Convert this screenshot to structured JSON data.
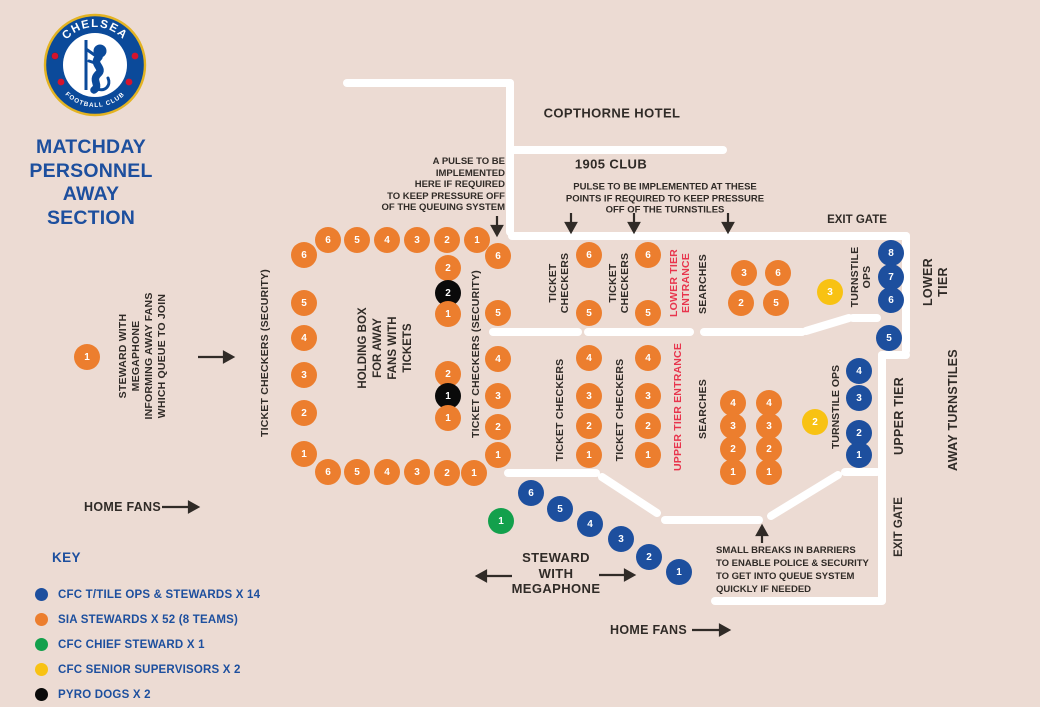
{
  "colors": {
    "blue": "#1d4f9e",
    "orange": "#ec7e2e",
    "green": "#13a04c",
    "yellow": "#f8c213",
    "black": "#0a0a0a",
    "wall": "#ffffff",
    "ink": "#302b27",
    "red": "#e8354d",
    "bg": "#ecdbd3"
  },
  "logo": {
    "top_text": "CHELSEA",
    "bottom_text": "FOOTBALL CLUB"
  },
  "title": {
    "lines": "MATCHDAY\nPERSONNEL\nAWAY\nSECTION"
  },
  "labels": {
    "copthorne_hotel": "COPTHORNE HOTEL",
    "club_1905": "1905 CLUB",
    "exit_gate_top": "EXIT GATE",
    "exit_gate_right": "EXIT GATE",
    "lower_tier": "LOWER\nTIER",
    "upper_tier": "UPPER TIER",
    "away_turnstiles": "AWAY TURNSTILES",
    "home_fans_left": "HOME FANS",
    "home_fans_bottom": "HOME FANS",
    "steward_megaphone_left": "STEWARD WITH\nMEGAPHONE\nINFORMING AWAY FANS\nWHICH QUEUE TO JOIN",
    "steward_megaphone_bottom": "STEWARD\nWITH\nMEGAPHONE",
    "ticket_checkers_security": "TICKET CHECKERS (SECURITY)",
    "holding_box": "HOLDING BOX\nFOR AWAY\nFANS WITH\nTICKETS",
    "ticket_checkers_2line": "TICKET\nCHECKERS",
    "ticket_checkers_1line": "TICKET CHECKERS",
    "lower_tier_entrance": "LOWER TIER\nENTRANCE",
    "upper_tier_entrance": "UPPER TIER ENTRANCE",
    "searches": "SEARCHES",
    "turnstile_ops_2line": "TURNSTILE\nOPS",
    "turnstile_ops_1line": "TURNSTILE OPS"
  },
  "annotations": {
    "pulse_left": "A PULSE TO BE\nIMPLEMENTED\nHERE IF REQUIRED\nTO KEEP PRESSURE OFF\nOF THE QUEUING SYSTEM",
    "pulse_right": "PULSE TO BE IMPLEMENTED AT THESE\nPOINTS IF REQUIRED TO KEEP PRESSURE\nOFF OF THE TURNSTILES",
    "small_breaks": "SMALL BREAKS IN BARRIERS\nTO ENABLE POLICE & SECURITY\nTO GET INTO QUEUE SYSTEM\nQUICKLY IF NEEDED"
  },
  "key": {
    "heading": "KEY",
    "items": [
      {
        "color": "blue",
        "label": "CFC T/TILE OPS & STEWARDS X 14"
      },
      {
        "color": "orange",
        "label": "SIA STEWARDS X 52 (8 TEAMS)"
      },
      {
        "color": "green",
        "label": "CFC CHIEF STEWARD X 1"
      },
      {
        "color": "yellow",
        "label": "CFC SENIOR SUPERVISORS X 2"
      },
      {
        "color": "black",
        "label": "PYRO DOGS X 2"
      }
    ]
  },
  "markers": [
    {
      "c": "orange",
      "n": "6",
      "x": 328,
      "y": 240
    },
    {
      "c": "orange",
      "n": "5",
      "x": 357,
      "y": 240
    },
    {
      "c": "orange",
      "n": "4",
      "x": 387,
      "y": 240
    },
    {
      "c": "orange",
      "n": "3",
      "x": 417,
      "y": 240
    },
    {
      "c": "orange",
      "n": "2",
      "x": 447,
      "y": 240
    },
    {
      "c": "orange",
      "n": "1",
      "x": 477,
      "y": 240
    },
    {
      "c": "orange",
      "n": "6",
      "x": 304,
      "y": 255
    },
    {
      "c": "orange",
      "n": "5",
      "x": 304,
      "y": 303
    },
    {
      "c": "orange",
      "n": "4",
      "x": 304,
      "y": 338
    },
    {
      "c": "orange",
      "n": "3",
      "x": 304,
      "y": 375
    },
    {
      "c": "orange",
      "n": "2",
      "x": 304,
      "y": 413
    },
    {
      "c": "orange",
      "n": "1",
      "x": 304,
      "y": 454
    },
    {
      "c": "orange",
      "n": "6",
      "x": 328,
      "y": 472
    },
    {
      "c": "orange",
      "n": "5",
      "x": 357,
      "y": 472
    },
    {
      "c": "orange",
      "n": "4",
      "x": 387,
      "y": 472
    },
    {
      "c": "orange",
      "n": "3",
      "x": 417,
      "y": 472
    },
    {
      "c": "orange",
      "n": "2",
      "x": 447,
      "y": 473
    },
    {
      "c": "orange",
      "n": "1",
      "x": 474,
      "y": 473
    },
    {
      "c": "orange",
      "n": "2",
      "x": 448,
      "y": 268
    },
    {
      "c": "black",
      "n": "2",
      "x": 448,
      "y": 293
    },
    {
      "c": "orange",
      "n": "1",
      "x": 448,
      "y": 314
    },
    {
      "c": "orange",
      "n": "2",
      "x": 448,
      "y": 374
    },
    {
      "c": "black",
      "n": "1",
      "x": 448,
      "y": 396
    },
    {
      "c": "orange",
      "n": "1",
      "x": 448,
      "y": 418
    },
    {
      "c": "orange",
      "n": "6",
      "x": 498,
      "y": 256
    },
    {
      "c": "orange",
      "n": "5",
      "x": 498,
      "y": 313
    },
    {
      "c": "orange",
      "n": "4",
      "x": 498,
      "y": 359
    },
    {
      "c": "orange",
      "n": "3",
      "x": 498,
      "y": 396
    },
    {
      "c": "orange",
      "n": "2",
      "x": 498,
      "y": 427
    },
    {
      "c": "orange",
      "n": "1",
      "x": 498,
      "y": 455
    },
    {
      "c": "orange",
      "n": "6",
      "x": 589,
      "y": 255
    },
    {
      "c": "orange",
      "n": "5",
      "x": 589,
      "y": 313
    },
    {
      "c": "orange",
      "n": "4",
      "x": 589,
      "y": 358
    },
    {
      "c": "orange",
      "n": "3",
      "x": 589,
      "y": 396
    },
    {
      "c": "orange",
      "n": "2",
      "x": 589,
      "y": 426
    },
    {
      "c": "orange",
      "n": "1",
      "x": 589,
      "y": 455
    },
    {
      "c": "orange",
      "n": "6",
      "x": 648,
      "y": 255
    },
    {
      "c": "orange",
      "n": "5",
      "x": 648,
      "y": 313
    },
    {
      "c": "orange",
      "n": "4",
      "x": 648,
      "y": 358
    },
    {
      "c": "orange",
      "n": "3",
      "x": 648,
      "y": 396
    },
    {
      "c": "orange",
      "n": "2",
      "x": 648,
      "y": 426
    },
    {
      "c": "orange",
      "n": "1",
      "x": 648,
      "y": 455
    },
    {
      "c": "orange",
      "n": "3",
      "x": 744,
      "y": 273
    },
    {
      "c": "orange",
      "n": "6",
      "x": 778,
      "y": 273
    },
    {
      "c": "orange",
      "n": "2",
      "x": 741,
      "y": 303
    },
    {
      "c": "orange",
      "n": "5",
      "x": 776,
      "y": 303
    },
    {
      "c": "orange",
      "n": "4",
      "x": 733,
      "y": 403
    },
    {
      "c": "orange",
      "n": "3",
      "x": 733,
      "y": 426
    },
    {
      "c": "orange",
      "n": "2",
      "x": 733,
      "y": 449
    },
    {
      "c": "orange",
      "n": "1",
      "x": 733,
      "y": 472
    },
    {
      "c": "orange",
      "n": "4",
      "x": 769,
      "y": 403
    },
    {
      "c": "orange",
      "n": "3",
      "x": 769,
      "y": 426
    },
    {
      "c": "orange",
      "n": "2",
      "x": 769,
      "y": 449
    },
    {
      "c": "orange",
      "n": "1",
      "x": 769,
      "y": 472
    },
    {
      "c": "orange",
      "n": "1",
      "x": 87,
      "y": 357
    },
    {
      "c": "yellow",
      "n": "3",
      "x": 830,
      "y": 292
    },
    {
      "c": "yellow",
      "n": "2",
      "x": 815,
      "y": 422
    },
    {
      "c": "blue",
      "n": "8",
      "x": 891,
      "y": 253
    },
    {
      "c": "blue",
      "n": "7",
      "x": 891,
      "y": 277
    },
    {
      "c": "blue",
      "n": "6",
      "x": 891,
      "y": 300
    },
    {
      "c": "blue",
      "n": "5",
      "x": 889,
      "y": 338
    },
    {
      "c": "blue",
      "n": "4",
      "x": 859,
      "y": 371
    },
    {
      "c": "blue",
      "n": "3",
      "x": 859,
      "y": 398
    },
    {
      "c": "blue",
      "n": "2",
      "x": 859,
      "y": 433
    },
    {
      "c": "blue",
      "n": "1",
      "x": 859,
      "y": 455
    },
    {
      "c": "blue",
      "n": "6",
      "x": 531,
      "y": 493
    },
    {
      "c": "blue",
      "n": "5",
      "x": 560,
      "y": 509
    },
    {
      "c": "blue",
      "n": "4",
      "x": 590,
      "y": 524
    },
    {
      "c": "blue",
      "n": "3",
      "x": 621,
      "y": 539
    },
    {
      "c": "blue",
      "n": "2",
      "x": 649,
      "y": 557
    },
    {
      "c": "blue",
      "n": "1",
      "x": 679,
      "y": 572
    },
    {
      "c": "green",
      "n": "1",
      "x": 501,
      "y": 521
    }
  ]
}
